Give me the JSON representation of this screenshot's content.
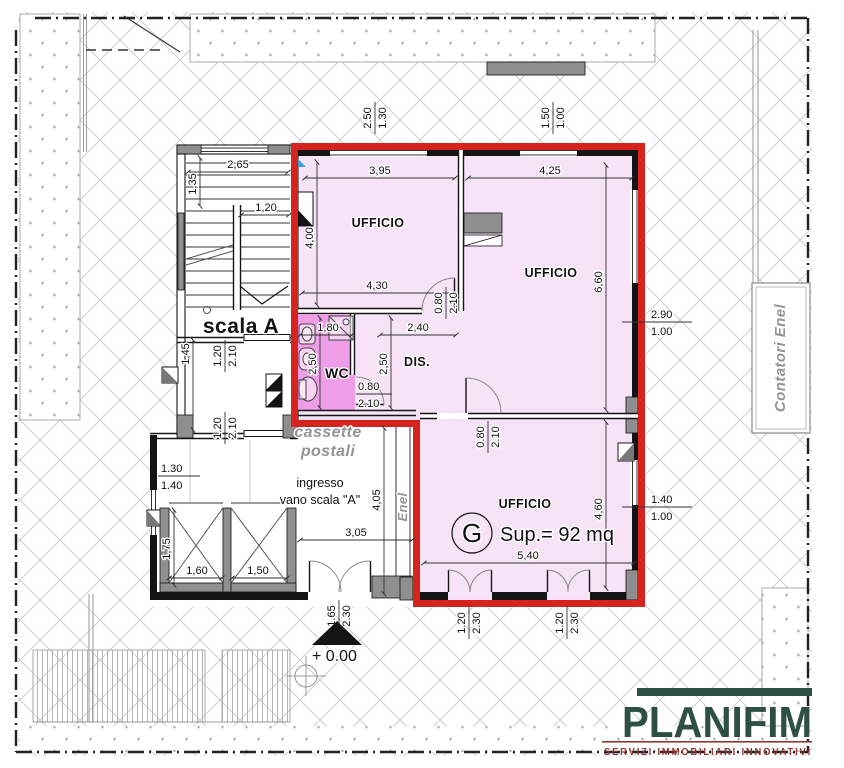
{
  "colors": {
    "red_boundary": "#d7231d",
    "unit_fill": "#f6e3f7",
    "wc_fill": "#ee9ee6",
    "gray_fill": "#8f8f8f",
    "hatch_line": "#cdcdcd",
    "stipple_dot": "#a8a8a8",
    "logo_green": "#2e4f44",
    "logo_red": "#8f3732",
    "blue_mark": "#3aa0d8"
  },
  "labels": {
    "office1": "UFFICIO",
    "office2": "UFFICIO",
    "office3": "UFFICIO",
    "wc": "WC",
    "dis": "DIS.",
    "scala": "scala A",
    "cassette_line1": "cassette",
    "cassette_line2": "postali",
    "ingresso_line1": "ingresso",
    "ingresso_line2": "vano scala \"A\"",
    "enel": "Enel",
    "contatori": "Contatori Enel",
    "elevation": "+ 0.00"
  },
  "unit": {
    "letter": "G",
    "area": "Sup.= 92 mq"
  },
  "dims": {
    "d395": "3,95",
    "d425": "4,25",
    "d400": "4,00",
    "d430": "4,30",
    "d660": "6,60",
    "d460": "4,60",
    "d540": "5,40",
    "d265": "2,65",
    "d135": "1,35",
    "d120": "1,20",
    "d145": "1,45",
    "d180": "1,80",
    "d240": "2,40",
    "d250a": "2,50",
    "d250b": "2,50",
    "d305": "3,05",
    "d405": "4,05",
    "d175": "1,75",
    "d160": "1,60",
    "d150": "1,50",
    "w_top_left": [
      "2.50",
      "1.30"
    ],
    "w_top_right": [
      "1.50",
      "1.00"
    ],
    "w_right_upper": [
      "2.90",
      "1.00"
    ],
    "w_right_lower": [
      "1.40",
      "1.00"
    ],
    "w_hall": [
      "1.30",
      "1.40"
    ],
    "door_offices": [
      "0.80",
      "2.10"
    ],
    "door_wc": [
      "0.80",
      "2.10"
    ],
    "door_office3": [
      "0.80",
      "2.10"
    ],
    "door_scala_a": [
      "1.20",
      "2.10"
    ],
    "door_scala_b": [
      "1.20",
      "2.10"
    ],
    "door_hall": [
      "1.65",
      "2.30"
    ],
    "door_g1": [
      "1.20",
      "2.30"
    ],
    "door_g2": [
      "1.20",
      "2.30"
    ]
  },
  "logo": {
    "name": "PLANIFIM",
    "tagline": "SERVIZI IMMOBILIARI INNOVATIVI"
  }
}
